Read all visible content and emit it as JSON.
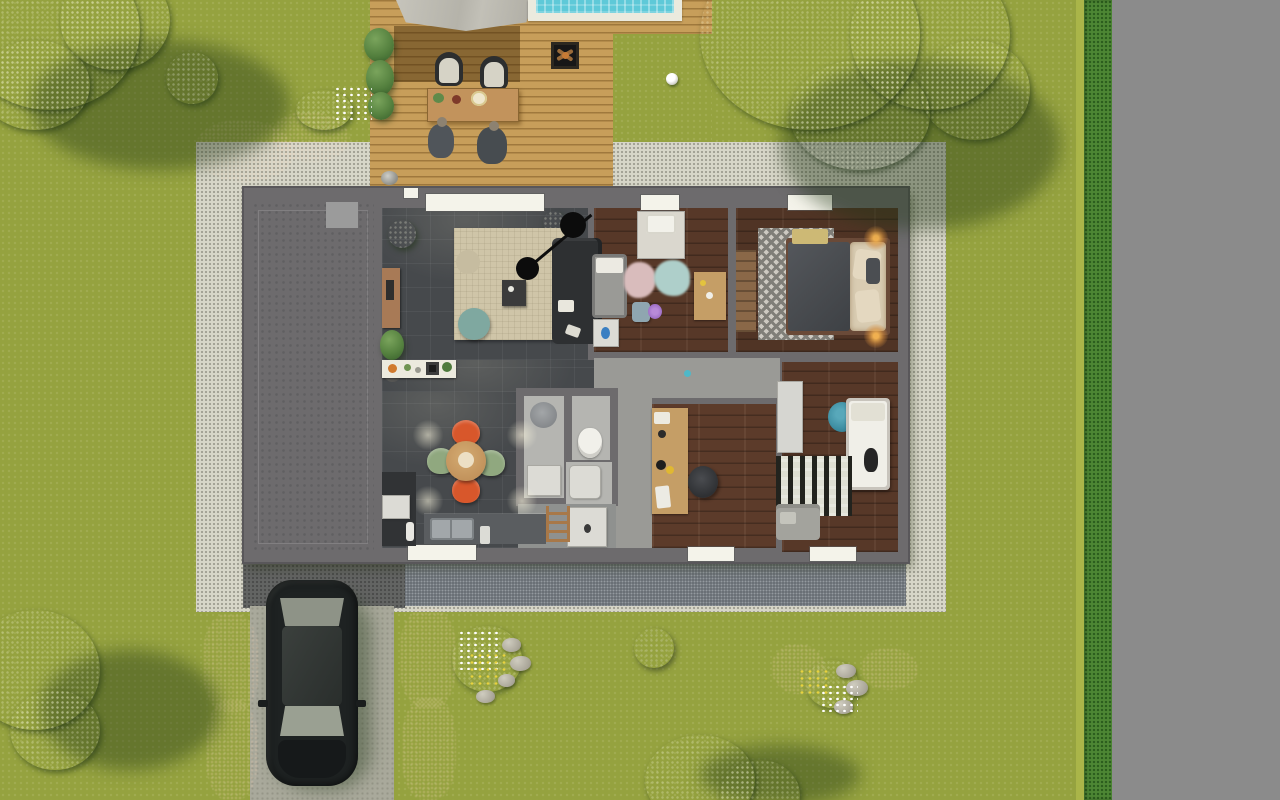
{
  "meta": {
    "description": "Photorealistic top-down 3D rendering of a single-storey house floor plan with furnished rooms, wooden terrace with pool edge, garden, driveway with parked car and street on the right",
    "view": "top-down",
    "canvas": {
      "width": 1280,
      "height": 800
    }
  },
  "colors": {
    "grass": "#95a23f",
    "grass-light": "#aab549",
    "road": "#8b8b8b",
    "hedge": "#4d8634",
    "gravel-light": "#d7d6c8",
    "gravel-dark": "#61676d",
    "driveway": "#a9a99b",
    "deck-wood": "#c79e5a",
    "awning": "#b9b7ae",
    "pool-water": "#5ec9d8",
    "pool-deck": "#ebeade",
    "wall": "#6d6b6d",
    "window": "#f4f3ea",
    "garage-floor": "#7e8184",
    "tile-floor": "#46494c",
    "wood-floor": "#573828",
    "hall-floor": "#9a9a96",
    "bath-floor": "#b5b5b1",
    "rug-beige": "#cfc5a8",
    "sofa": "#2e3032",
    "pouf-teal": "#7fa8a0",
    "chair-orange": "#d8572b",
    "chair-green": "#90a87f",
    "table-wood": "#c2935c",
    "desk-wood": "#c59e66",
    "car-body": "#1e2222",
    "car-glass": "#9aa092",
    "shrub-red": "#a24e2a",
    "tree": "#55813f",
    "tree-light": "#7aa45c",
    "tree-dark": "#3a632d",
    "duvet-dark": "#4b4e52",
    "bed-beige": "#d9ccb2",
    "chair-teal": "#3f8fa3",
    "pink-rug": "#d9bcbc",
    "blue-rug": "#aecfca",
    "lamp-glow": "#d98f3e"
  },
  "environment": {
    "lawn": "grass lawn",
    "road": {
      "name": "street",
      "side": "right"
    },
    "hedge": {
      "name": "trimmed hedge along street"
    },
    "gravel_border": {
      "name": "light gravel border around house"
    },
    "drain_gravel": {
      "name": "dark gravel strip below house"
    },
    "trees": [
      {
        "name": "large tree top-left"
      },
      {
        "name": "large tree top-right"
      },
      {
        "name": "tree bottom-left"
      },
      {
        "name": "tree bottom-center"
      }
    ],
    "shrubs": [
      {
        "name": "red shrub band top-left"
      },
      {
        "name": "red shrub left of driveway"
      },
      {
        "name": "red shrub right of driveway"
      },
      {
        "name": "small bush top-left"
      },
      {
        "name": "small gray-green bush bottom-center"
      }
    ],
    "flower_beds": [
      {
        "name": "rock flower bed near driveway",
        "details": "white and yellow flowers with gray rocks"
      },
      {
        "name": "rock flower bed bottom-right",
        "details": "red shrubs, rocks, white flowers"
      }
    ],
    "soccer_ball": {
      "name": "soccer ball on lawn"
    }
  },
  "deck": {
    "name": "wooden terrace",
    "elements": {
      "awning": "gray canopy / awning",
      "pool": "swimming pool edge with turquoise water",
      "fire_pit": "square fire pit with logs",
      "lounge_chairs": 2,
      "dining_table": "wooden outdoor dining table with plates",
      "people": 2,
      "grill": "small kettle grill",
      "planters": "tall grasses along left edge"
    }
  },
  "driveway": {
    "name": "concrete driveway",
    "vehicle": {
      "name": "parked car",
      "color_name": "black hatchback"
    }
  },
  "house": {
    "windows": {
      "top_wall": 3,
      "bottom_wall": 3
    },
    "front_door": {
      "name": "entrance door on terrace side"
    },
    "rooms": [
      {
        "id": "garage",
        "name": "Garage",
        "floor": "concrete",
        "furniture": []
      },
      {
        "id": "living",
        "name": "Living room",
        "floor": "dark tile",
        "furniture": [
          "beige area rug",
          "dark corner sofa",
          "coffee table",
          "beige pouf",
          "teal pouf",
          "double pendant lamp",
          "wooden sideboard",
          "potted plants",
          "floor vase"
        ]
      },
      {
        "id": "kitchen",
        "name": "Kitchen / dining",
        "floor": "dark tile",
        "furniture": [
          "white island counter with hob",
          "round wooden dining table",
          "2 orange chairs",
          "2 green chairs",
          "sink counter",
          "white appliance",
          "dark cabinet",
          "ceiling spotlights"
        ]
      },
      {
        "id": "bathroom",
        "name": "Bathroom",
        "floor": "light tile",
        "furniture": [
          "shower cabin with rain head",
          "toilet",
          "washbasin",
          "walk-in shower tray",
          "wooden towel ladder"
        ]
      },
      {
        "id": "hall",
        "name": "Hallway",
        "floor": "light gray",
        "furniture": []
      },
      {
        "id": "bedroom_kids",
        "name": "Kids bedroom",
        "floor": "dark wood",
        "furniture": [
          "cot bed",
          "white nightstand with blue vase",
          "changing dresser",
          "pink fluffy rug",
          "blue fluffy rug",
          "wooden desk",
          "stool",
          "purple flowers"
        ]
      },
      {
        "id": "bedroom_master",
        "name": "Master bedroom",
        "floor": "dark wood",
        "furniture": [
          "double bed with dark duvet",
          "beige headboard pillows",
          "yellow throw",
          "chevron rug",
          "wooden bench",
          "2 glowing bedside lamps"
        ]
      },
      {
        "id": "bedroom_single",
        "name": "Single bedroom",
        "floor": "dark wood",
        "furniture": [
          "single bed with white duvet",
          "teal round chair",
          "black-white wave rug",
          "gray loveseat",
          "white wardrobe"
        ]
      },
      {
        "id": "office",
        "name": "Home office",
        "floor": "dark wood",
        "furniture": [
          "wooden desk along wall",
          "black office chair",
          "desk lamp",
          "papers"
        ]
      }
    ]
  }
}
